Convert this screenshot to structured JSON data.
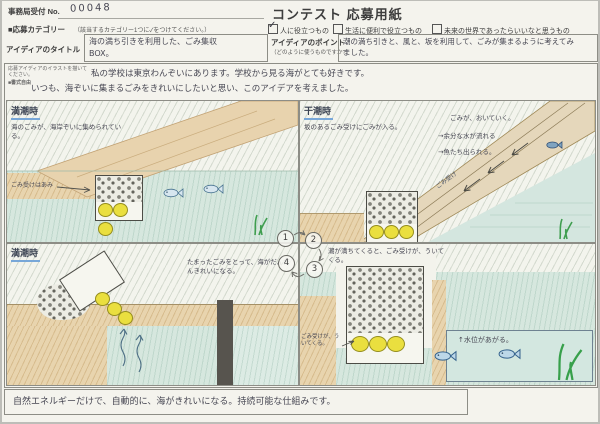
{
  "palette": {
    "paper": "#f4f3ed",
    "sea": "#d6e7de",
    "sand": "#e8d4ae",
    "buoy_yellow": "#eadf3f",
    "seaweed_green": "#3f9e4f",
    "title_underline_blue": "#78a7d8"
  },
  "header": {
    "receipt_label": "事務局受付 No.",
    "receipt_number": "00048",
    "form_title": "コンテスト 応募用紙"
  },
  "category": {
    "label": "■応募カテゴリー",
    "note": "（該当するカテゴリー1つに✓をつけてください。）",
    "check_glyph": "✓",
    "options": [
      {
        "label": "人に役立つもの",
        "checked": true
      },
      {
        "label": "生活に便利で役立つもの",
        "checked": false
      },
      {
        "label": "未来の世界であったらいいなと思うもの",
        "checked": false
      }
    ]
  },
  "idea_title": {
    "label": "アイディアのタイトル",
    "value": "海の満ち引きを利用した、ごみ集収BOX。"
  },
  "idea_point": {
    "label": "アイディアのポイント",
    "note": "（どのように使うものですか?）",
    "value": "潮の満ち引きと、風と、坂を利用して、ごみが集まるように考えてみました。"
  },
  "illustration": {
    "instruction": "応募アイディアのイラストを描いてください。",
    "format_note": "■書式自由",
    "intro_line1": "私の学校は東京わんぞいにあります。学校から見る海がとても好きです。",
    "intro_line2": "いつも、海ぞいに集まるごみをきれいにしたいと思い、このアイデアを考えました。",
    "panel1": {
      "title": "満潮時",
      "caption": "海のごみが、海岸ぞいに集められている。",
      "net_label": "ごみ受けはあみ"
    },
    "panel2": {
      "title": "干潮時",
      "caption": "坂のあるごみ受けにごみが入る。",
      "note1": "ごみが、おいていく。",
      "note2": "→余分な水が流れる",
      "note3": "→魚たち出られる。",
      "slope_label": "ごみ受け"
    },
    "panel3": {
      "title": "満潮時",
      "caption": "たまったごみをとって、海がだんだんきれいになる。"
    },
    "panel4": {
      "caption": "潮が満ちてくると、ごみ受けが、ういてくる。",
      "float_label": "ごみ受けが、ういてくる。",
      "water_label": "↑水位があがる。"
    },
    "cycle": {
      "steps": [
        "1",
        "2",
        "3",
        "4"
      ]
    }
  },
  "footer": {
    "text": "自然エネルギーだけで、自動的に、海がきれいになる。持続可能な仕組みです。"
  }
}
